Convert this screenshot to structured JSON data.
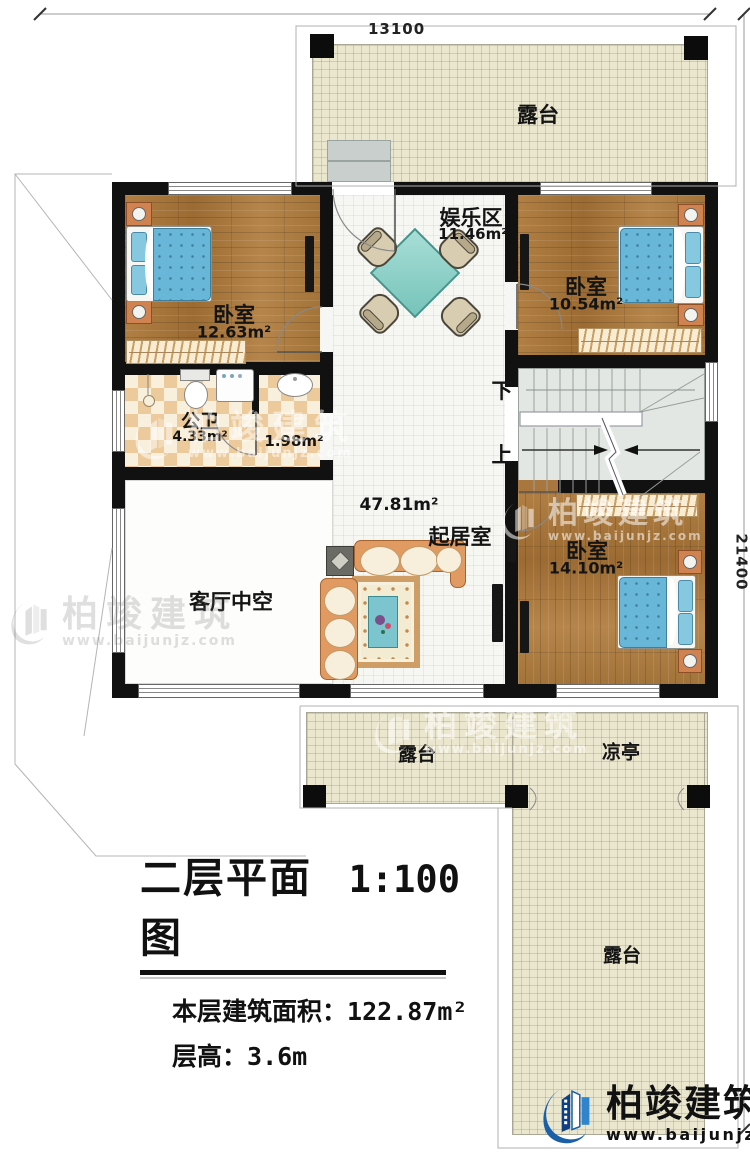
{
  "dimensions": {
    "top": "13100",
    "right": "21400"
  },
  "rooms": {
    "terrace_top": {
      "label": "露台"
    },
    "bedroom1": {
      "label": "卧室",
      "area": "12.63m²"
    },
    "entertainment": {
      "label": "娱乐区",
      "area": "11.46m²"
    },
    "bedroom2": {
      "label": "卧室",
      "area": "10.54m²"
    },
    "bathroom": {
      "label": "公卫",
      "area": "4.33m²"
    },
    "wash_area": {
      "area": "1.98m²"
    },
    "living": {
      "label": "起居室",
      "area": "47.81m²"
    },
    "void": {
      "label": "客厅中空"
    },
    "bedroom3": {
      "label": "卧室",
      "area": "14.10m²"
    },
    "terrace_bottom": {
      "label": "露台"
    },
    "pavilion": {
      "label": "凉亭"
    },
    "terrace_right": {
      "label": "露台"
    }
  },
  "stairs": {
    "down_label": "下",
    "up_label": "上"
  },
  "title_block": {
    "title": "二层平面图",
    "scale": "1:100",
    "area_label": "本层建筑面积：",
    "area_value": "122.87m²",
    "floor_height_label": "层高：",
    "floor_height_value": "3.6m"
  },
  "branding": {
    "company": "柏竣建筑",
    "website": "www.baijunjz.com"
  },
  "colors": {
    "wall": "#111111",
    "wood_floor": "#a9773d",
    "tile_floor": "#f6f6f3",
    "terrace_floor": "#ebe7cf",
    "checker_floor": "#ecca9b",
    "stairs_floor": "#e3e7e3",
    "bed_blue": "#68b7d8",
    "table_teal": "#8ed1c9",
    "sofa_peach": "#e09a62",
    "brand_blue": "#1a5fa8"
  }
}
